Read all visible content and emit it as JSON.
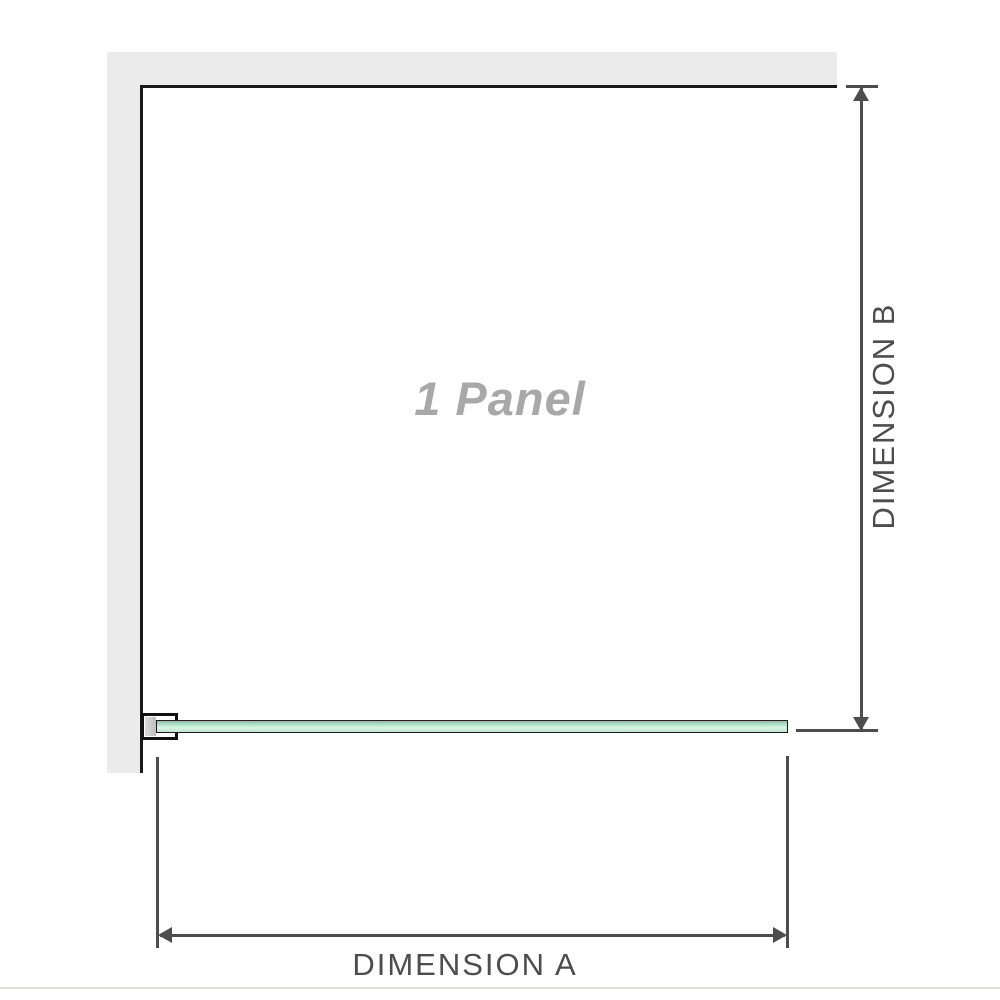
{
  "diagram": {
    "panel_label": "1 Panel",
    "dimension_a_label": "DIMENSION A",
    "dimension_b_label": "DIMENSION B"
  },
  "colors": {
    "wall_fill": "#ebebeb",
    "wall_edge": "#1a1a1a",
    "dimension_lines_and_text": "#4d4d4d",
    "panel_label_text": "#a8a8a8",
    "glass_border": "#1c1c1c",
    "glass_green_light": "#dcf2e5",
    "glass_green_mid": "#a7dbc1",
    "glass_green_dark": "#7fc5a3",
    "bracket_border": "#111111",
    "bracket_pad": "#bdbdbd",
    "baseline": "#e0ded8"
  }
}
